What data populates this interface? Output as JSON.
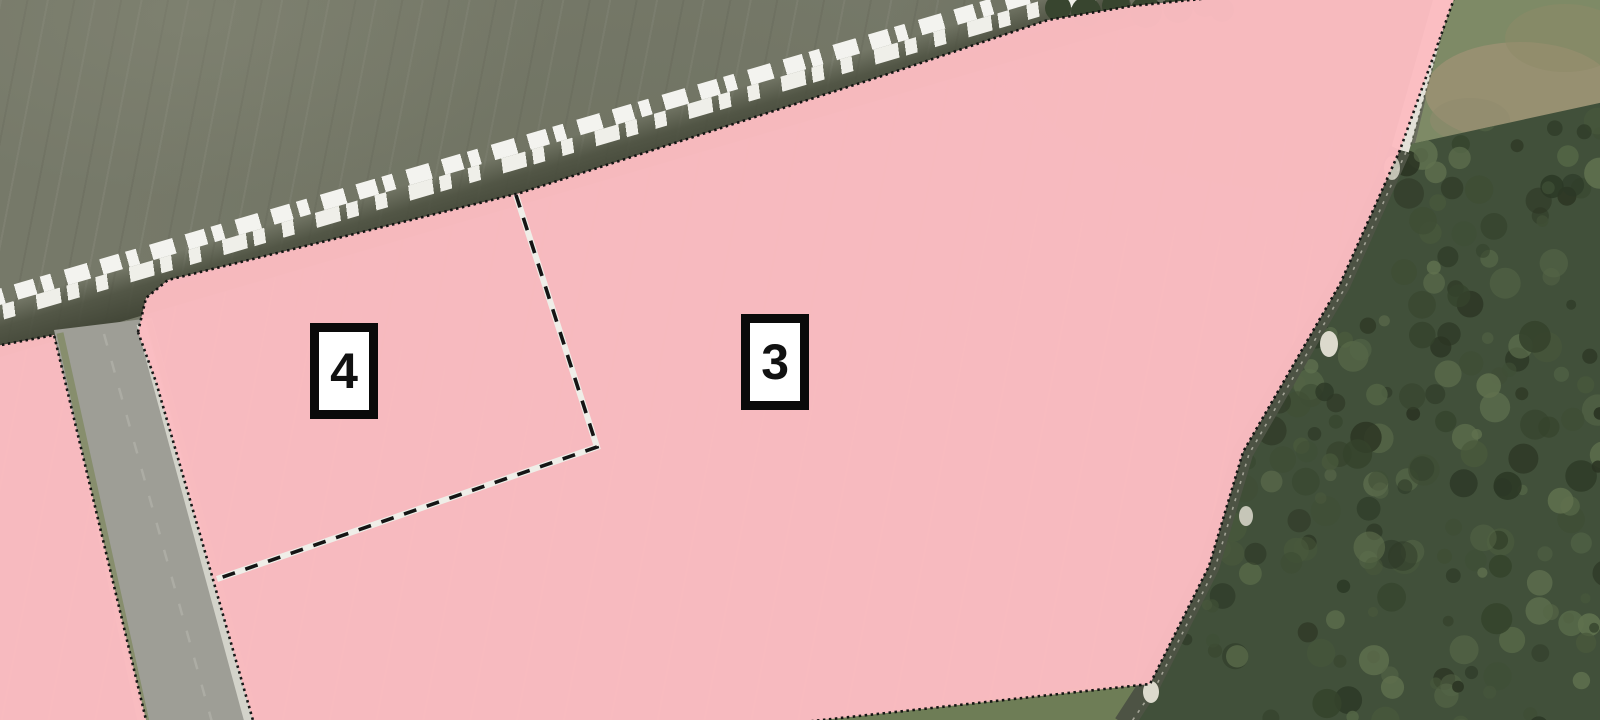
{
  "map": {
    "description": "Aerial orthophoto with pink zoning overlay polygons",
    "zone_markers": [
      {
        "id": "3",
        "x_pct": 48.45,
        "y_pct": 50.3
      },
      {
        "id": "4",
        "x_pct": 21.5,
        "y_pct": 51.5
      }
    ],
    "colors": {
      "zone_overlay": "#fcbdc2",
      "zone_boundary_dots": "#121212",
      "divider_dash": "#151515",
      "divider_casing": "#efeee8",
      "field": "#767969",
      "forest": "#41503a",
      "grass": "#7e8a66",
      "road": "#9e9e96",
      "track": "#4d5344",
      "white_strip": "#f3f3ef"
    }
  }
}
